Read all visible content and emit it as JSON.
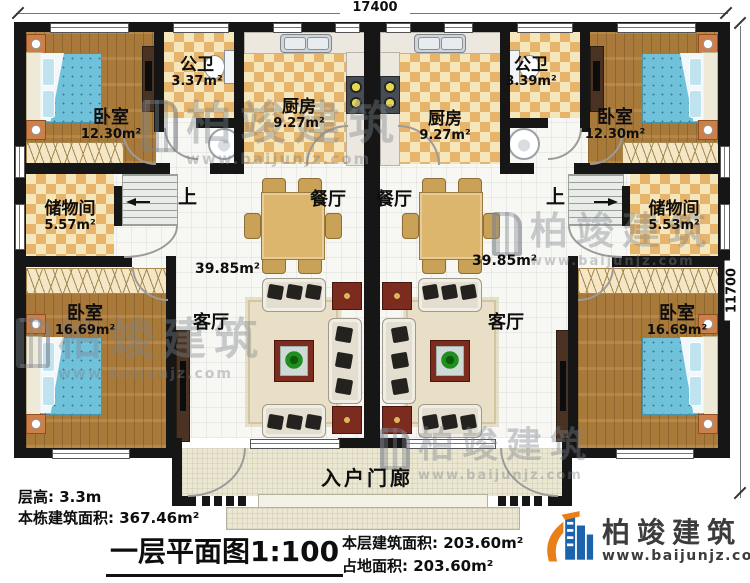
{
  "dimensions": {
    "top": "17400",
    "right": "11700"
  },
  "unit_left": {
    "bedroom_top": {
      "name": "卧室",
      "area": "12.30m²"
    },
    "bathroom": {
      "name": "公卫",
      "area": "3.37m²"
    },
    "kitchen": {
      "name": "厨房",
      "area": "9.27m²"
    },
    "storage": {
      "name": "储物间",
      "area": "5.57m²"
    },
    "bedroom_bottom": {
      "name": "卧室",
      "area": "16.69m²"
    },
    "dining": {
      "name": "餐厅"
    },
    "living": {
      "name": "客厅"
    },
    "hall_area": "39.85m²",
    "stairs_up": "上"
  },
  "unit_right": {
    "bedroom_top": {
      "name": "卧室",
      "area": "12.30m²"
    },
    "bathroom": {
      "name": "公卫",
      "area": "3.39m²"
    },
    "kitchen": {
      "name": "厨房",
      "area": "9.27m²"
    },
    "storage": {
      "name": "储物间",
      "area": "5.53m²"
    },
    "bedroom_bottom": {
      "name": "卧室",
      "area": "16.69m²"
    },
    "dining": {
      "name": "餐厅"
    },
    "living": {
      "name": "客厅"
    },
    "hall_area": "39.85m²",
    "stairs_up": "上"
  },
  "porch": {
    "name": "入户门廊"
  },
  "footer": {
    "floor_height": "层高: 3.3m",
    "building_area": "本栋建筑面积: 367.46m²",
    "title": "一层平面图1:100",
    "this_floor_area": "本层建筑面积: 203.60m²",
    "land_area": "占地面积: 203.60m²"
  },
  "brand": {
    "name": "柏竣建筑",
    "website": "www.baijunjz.com"
  },
  "colors": {
    "wall": "#161616",
    "checker_tile": "#e7b46b",
    "wood_floor": "#b2813e",
    "bed": "#70c2da",
    "brand_blue": "#1b63ad",
    "brand_orange": "#e87f17",
    "watermark": "#7d858c"
  }
}
